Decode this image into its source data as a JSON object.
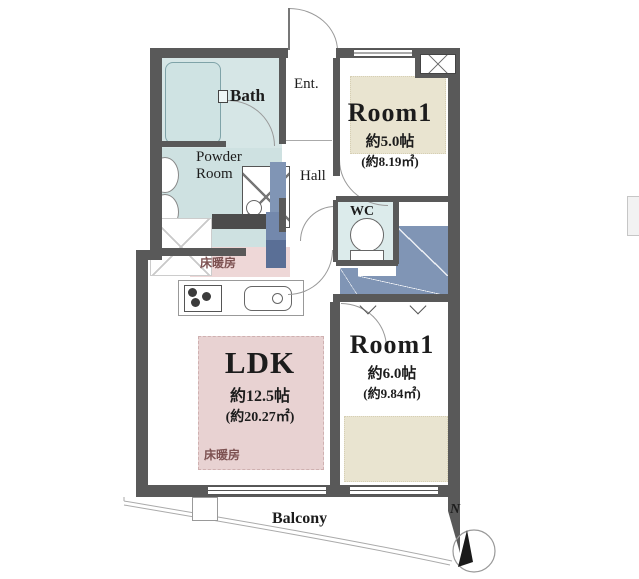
{
  "rooms": {
    "bath": {
      "label": "Bath"
    },
    "powder_room": {
      "label_line1": "Powder",
      "label_line2": "Room"
    },
    "entrance": {
      "label": "Ent."
    },
    "hall": {
      "label": "Hall"
    },
    "wc": {
      "label": "WC"
    },
    "room1_north": {
      "label": "Room1",
      "size": "約5.0帖",
      "area": "(約8.19㎡)"
    },
    "ldk": {
      "label": "LDK",
      "size": "約12.5帖",
      "area": "(約20.27㎡)"
    },
    "room1_south": {
      "label": "Room1",
      "size": "約6.0帖",
      "area": "(約9.84㎡)"
    },
    "balcony": {
      "label": "Balcony"
    }
  },
  "annotations": {
    "floor_heating_kitchen": "床暖房",
    "floor_heating_ldk": "床暖房",
    "compass_north": "N"
  },
  "colors": {
    "wall": "#595959",
    "wet_area_blue": "#d6e6e6",
    "closet_blue": "#8095b5",
    "floor_heating_pink": "#e8d2d2",
    "tatami_beige": "#e9e4d0"
  }
}
